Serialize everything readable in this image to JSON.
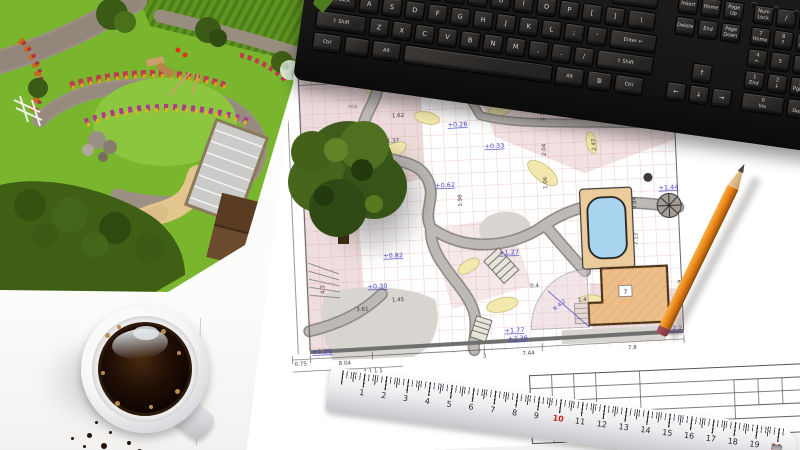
{
  "keyboard": {
    "body_color": "#1a1918",
    "key_color": "#34312f",
    "backspace": "← Backspace",
    "qwerty_row": [
      "",
      "Q",
      "W",
      "E",
      "R",
      "T",
      "Y",
      "U",
      "I",
      "O",
      "P",
      "[",
      "]",
      "\\"
    ],
    "home_row": [
      "Caps Lock",
      "A",
      "S",
      "D",
      "F",
      "G",
      "H",
      "J",
      "K",
      "L",
      ";",
      "'",
      "Enter ↵"
    ],
    "shift_row": [
      "⇧ Shift",
      "Z",
      "X",
      "C",
      "V",
      "B",
      "N",
      "M",
      ",",
      ".",
      "/",
      "⇧ Shift"
    ],
    "bottom_row": [
      "Ctrl",
      "",
      "Alt",
      "",
      "Alt",
      "≣",
      "Ctrl"
    ],
    "nav_top": [
      "Insert",
      "Home",
      "Page\nUp"
    ],
    "nav_mid": [
      "Delete",
      "End",
      "Page\nDown"
    ],
    "arrow_up": "↑",
    "arrow_left": "←",
    "arrow_down": "↓",
    "arrow_right": "→",
    "numpad_r0": [
      "Num\nLock",
      "/",
      "*",
      "-"
    ],
    "numpad_r1": [
      "7\nHome",
      "8\n↑",
      "9\nPgUp",
      "+"
    ],
    "numpad_r2": [
      "4\n←",
      "5",
      "6\n→"
    ],
    "numpad_r3": [
      "1\nEnd",
      "2\n↓",
      "3\nPgDn"
    ],
    "numpad_r4": [
      "0\nIns",
      ".\nDel",
      "Enter"
    ]
  },
  "blueprint": {
    "elevations": [
      "+0.02",
      "+0.26",
      "+0.33",
      "+0.62",
      "+0.27",
      "+0.82",
      "+0.30",
      "+1.27",
      "+1.44",
      "+1.77",
      "+2.36",
      "+2.2",
      "+1.26"
    ],
    "dimensions": [
      "2.73",
      "1.62",
      "1.37",
      "50",
      "3.8",
      "1.8",
      "3.6",
      "2.12",
      "2.04",
      "1.06",
      "9.84",
      "7.13",
      "2.84",
      "8.72",
      "4.3",
      "2.47",
      "1.98",
      "1.4",
      "0.4",
      "1.45",
      "3.61",
      "2.9",
      "1  1  1  1"
    ],
    "bottom_dimensions": [
      "0.75",
      "8.04",
      "3",
      "7.44",
      "7.8"
    ],
    "house_label": "7",
    "radius_label": "R 4.2",
    "area_label": "пса",
    "colors": {
      "grid": "#dd8888",
      "path": "#b4b0ac",
      "bed": "#f2e8ad",
      "pool_water": "#a9d5f1",
      "pool_deck": "#eccb9d",
      "house": "#edbe8a",
      "elevation_text": "#4540c4"
    }
  },
  "ruler": {
    "numbers": [
      1,
      2,
      3,
      4,
      5,
      6,
      7,
      8,
      9,
      10,
      11,
      12,
      13,
      14,
      15,
      16,
      17,
      18,
      19,
      20
    ],
    "red_numbers": [
      10,
      20
    ]
  },
  "pencil": {
    "color": "#e8821e"
  },
  "coffee": {
    "color": "#1c0f06"
  },
  "garden": {
    "colors": {
      "lawn": "#79b62e",
      "stone_path": "#9b9083",
      "sand_path": "#e2c68e",
      "roof": "#6b4a2e",
      "hedge": "#4d7d18"
    }
  }
}
